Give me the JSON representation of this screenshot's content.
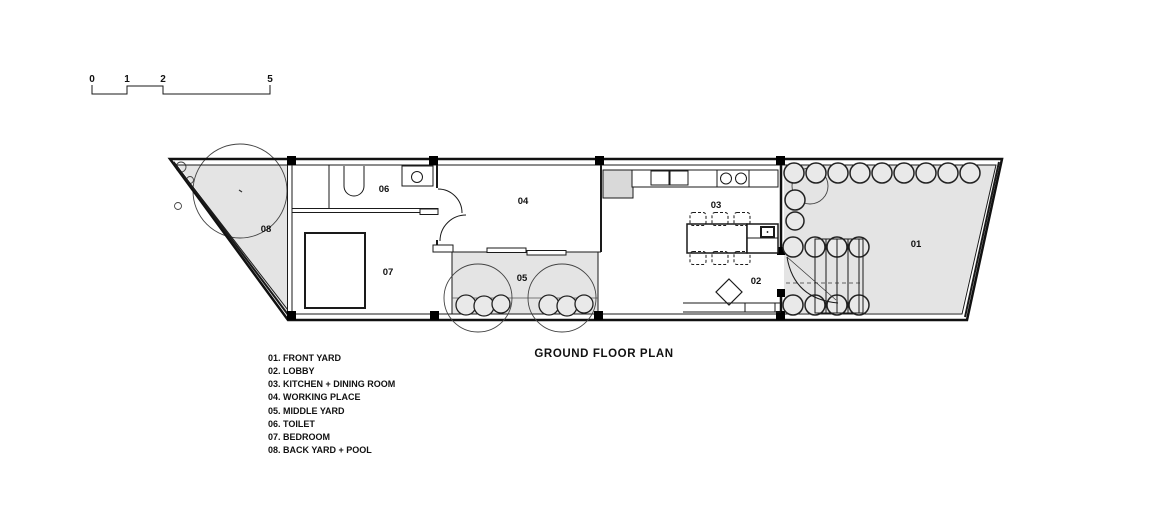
{
  "title": "GROUND FLOOR PLAN",
  "scale_bar": {
    "marks": [
      "0",
      "1",
      "2",
      "5"
    ]
  },
  "rooms": {
    "front_yard": "01",
    "lobby": "02",
    "kitchen_dining": "03",
    "working_place": "04",
    "middle_yard": "05",
    "toilet": "06",
    "bedroom": "07",
    "back_yard_pool": "08"
  },
  "legend": [
    "01. FRONT YARD",
    "02. LOBBY",
    "03. KITCHEN + DINING ROOM",
    "04. WORKING PLACE",
    "05. MIDDLE YARD",
    "06. TOILET",
    "07. BEDROOM",
    "08. BACK YARD + POOL"
  ],
  "colors": {
    "line": "#1a1a1a",
    "yard_fill": "#e4e4e4",
    "shrub_fill": "#e9e9e9",
    "cabinet_fill": "#d9d9d9",
    "column_fill": "#000000"
  }
}
